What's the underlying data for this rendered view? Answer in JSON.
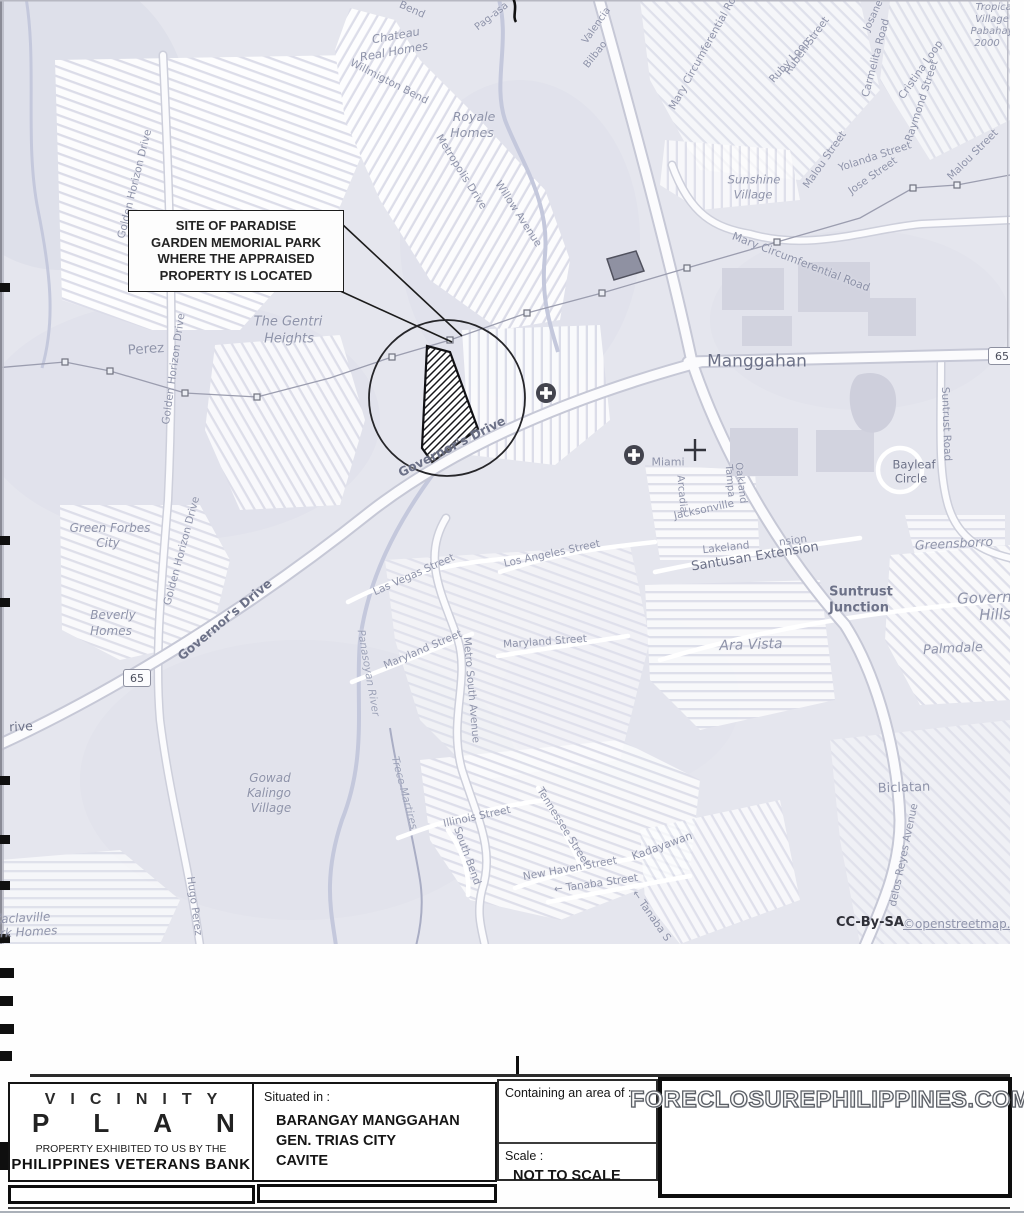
{
  "map": {
    "background": "#e5e6ee",
    "callout": {
      "lines": [
        "SITE OF PARADISE",
        "GARDEN MEMORIAL PARK",
        "WHERE THE APPRAISED",
        "PROPERTY IS LOCATED"
      ]
    },
    "route_shields": [
      {
        "label": "65",
        "x": 1002,
        "y": 356
      },
      {
        "label": "65",
        "x": 137,
        "y": 678
      }
    ],
    "attribution": {
      "text": "CC-By-SA",
      "link": "©openstreetmap.org"
    },
    "icons": [
      {
        "name": "hospital-icon",
        "x": 546,
        "y": 393
      },
      {
        "name": "hospital-icon",
        "x": 634,
        "y": 455
      },
      {
        "name": "junction-cross-icon",
        "x": 695,
        "y": 450
      }
    ],
    "labels": [
      {
        "t": "Bend",
        "x": 412,
        "y": 10,
        "r": 24,
        "fs": 10.5
      },
      {
        "t": "Pag-asa",
        "x": 492,
        "y": 17,
        "r": -38,
        "fs": 10
      },
      {
        "t": "Valencia",
        "x": 597,
        "y": 26,
        "r": -55,
        "fs": 10
      },
      {
        "t": "Bilbao",
        "x": 596,
        "y": 55,
        "r": -52,
        "fs": 10
      },
      {
        "t": "Chateau",
        "x": 396,
        "y": 36,
        "r": -10,
        "fs": 11.5,
        "it": 1
      },
      {
        "t": "Real Homes",
        "x": 394,
        "y": 52,
        "r": -10,
        "fs": 11.5,
        "it": 1
      },
      {
        "t": "Willmigton Bend",
        "x": 389,
        "y": 82,
        "r": 27,
        "fs": 10.5
      },
      {
        "t": "Royale",
        "x": 474,
        "y": 117,
        "fs": 12.5,
        "it": 1
      },
      {
        "t": "Homes",
        "x": 472,
        "y": 133,
        "fs": 12.5,
        "it": 1
      },
      {
        "t": "Metropolis Drive",
        "x": 461,
        "y": 172,
        "r": 58,
        "fs": 10.5
      },
      {
        "t": "Willow Avenue",
        "x": 518,
        "y": 214,
        "r": 57,
        "fs": 10.5
      },
      {
        "t": "Mary Circumferential Road",
        "x": 706,
        "y": 48,
        "r": -61,
        "fs": 10.5
      },
      {
        "t": "Josane",
        "x": 874,
        "y": 16,
        "r": -65,
        "fs": 10
      },
      {
        "t": "Ruben Street",
        "x": 807,
        "y": 46,
        "r": -54,
        "fs": 10.5
      },
      {
        "t": "Ruby Loop",
        "x": 790,
        "y": 61,
        "r": -48,
        "fs": 10.5
      },
      {
        "t": "Carmelita Road",
        "x": 876,
        "y": 58,
        "r": -75,
        "fs": 10.5
      },
      {
        "t": "Cristina Loop",
        "x": 921,
        "y": 70,
        "r": -55,
        "fs": 10.5
      },
      {
        "t": "Raymond Street",
        "x": 922,
        "y": 101,
        "r": -72,
        "fs": 10.5
      },
      {
        "t": "Malou Street",
        "x": 825,
        "y": 160,
        "r": -55,
        "fs": 10.5
      },
      {
        "t": "Yolanda Street",
        "x": 875,
        "y": 157,
        "r": -18,
        "fs": 10.5
      },
      {
        "t": "Jose Street",
        "x": 873,
        "y": 176,
        "r": -35,
        "fs": 10.5
      },
      {
        "t": "Malou Street",
        "x": 973,
        "y": 155,
        "r": -45,
        "fs": 10.5
      },
      {
        "t": "Sunshine",
        "x": 754,
        "y": 180,
        "fs": 11.5,
        "it": 1
      },
      {
        "t": "Village",
        "x": 753,
        "y": 195,
        "fs": 11.5,
        "it": 1
      },
      {
        "t": "Tropical",
        "x": 995,
        "y": 8,
        "fs": 10,
        "it": 1
      },
      {
        "t": "Village",
        "x": 992,
        "y": 20,
        "fs": 10,
        "it": 1
      },
      {
        "t": "Pabahay",
        "x": 992,
        "y": 32,
        "fs": 10,
        "it": 1
      },
      {
        "t": "2000",
        "x": 987,
        "y": 44,
        "fs": 10,
        "it": 1
      },
      {
        "t": "Mary Circumferential Road",
        "x": 801,
        "y": 262,
        "r": 21,
        "fs": 11
      },
      {
        "t": "Manggahan",
        "x": 757,
        "y": 362,
        "fs": 17,
        "c": "d"
      },
      {
        "t": "Suntrust Road",
        "x": 946,
        "y": 424,
        "r": 88,
        "fs": 10.5
      },
      {
        "t": "Bayleaf",
        "x": 914,
        "y": 465,
        "fs": 11.5,
        "c": "d"
      },
      {
        "t": "Circle",
        "x": 911,
        "y": 479,
        "fs": 11.5,
        "c": "d"
      },
      {
        "t": "Miami",
        "x": 668,
        "y": 462,
        "fs": 11
      },
      {
        "t": "Oakland",
        "x": 740,
        "y": 483,
        "r": 83,
        "fs": 10
      },
      {
        "t": "Tampa",
        "x": 729,
        "y": 481,
        "r": 85,
        "fs": 10
      },
      {
        "t": "Arcadia",
        "x": 681,
        "y": 494,
        "r": 85,
        "fs": 10
      },
      {
        "t": "Jacksonville",
        "x": 704,
        "y": 510,
        "r": -12,
        "fs": 10.5
      },
      {
        "t": "Lakeland",
        "x": 726,
        "y": 548,
        "r": -6,
        "fs": 10.5
      },
      {
        "t": "Santusan Extension",
        "x": 755,
        "y": 557,
        "r": -9,
        "fs": 13,
        "c": "d"
      },
      {
        "t": "nsion",
        "x": 793,
        "y": 541,
        "r": -8,
        "fs": 10.5
      },
      {
        "t": "Governor's Drive",
        "x": 452,
        "y": 447,
        "r": -27,
        "fs": 12.5,
        "c": "d",
        "b": 1
      },
      {
        "t": "Governor's Drive",
        "x": 225,
        "y": 620,
        "r": -40,
        "fs": 12.5,
        "c": "d",
        "b": 1
      },
      {
        "t": "Golden Horizon Drive",
        "x": 135,
        "y": 184,
        "r": -76,
        "fs": 10.5
      },
      {
        "t": "Golden Horizon Drive",
        "x": 174,
        "y": 369,
        "r": -82,
        "fs": 10.5
      },
      {
        "t": "Golden Horizon Drive",
        "x": 182,
        "y": 551,
        "r": -75,
        "fs": 10.5
      },
      {
        "t": "Perez",
        "x": 146,
        "y": 350,
        "r": -4,
        "fs": 13.5
      },
      {
        "t": "The Gentri",
        "x": 288,
        "y": 322,
        "fs": 13,
        "it": 1
      },
      {
        "t": "Heights",
        "x": 289,
        "y": 339,
        "fs": 13,
        "it": 1
      },
      {
        "t": "Green Forbes",
        "x": 110,
        "y": 528,
        "fs": 12,
        "it": 1
      },
      {
        "t": "City",
        "x": 108,
        "y": 543,
        "fs": 12,
        "it": 1
      },
      {
        "t": "Beverly",
        "x": 113,
        "y": 615,
        "fs": 12,
        "it": 1
      },
      {
        "t": "Homes",
        "x": 111,
        "y": 631,
        "fs": 12,
        "it": 1
      },
      {
        "t": "rive",
        "x": 21,
        "y": 727,
        "r": -3,
        "fs": 12.5,
        "c": "d"
      },
      {
        "t": "Las Vegas Street",
        "x": 414,
        "y": 575,
        "r": -24,
        "fs": 10.5
      },
      {
        "t": "Los Angeles Street",
        "x": 552,
        "y": 554,
        "r": -12,
        "fs": 10.5
      },
      {
        "t": "Maryland Street",
        "x": 423,
        "y": 650,
        "r": -23,
        "fs": 10.5
      },
      {
        "t": "Maryland Street",
        "x": 545,
        "y": 642,
        "r": -4,
        "fs": 10.5
      },
      {
        "t": "Metro South Avenue",
        "x": 471,
        "y": 690,
        "r": 85,
        "fs": 10.5
      },
      {
        "t": "Panasoyan River",
        "x": 368,
        "y": 673,
        "r": 80,
        "fs": 10.5,
        "c": "i",
        "it": 1
      },
      {
        "t": "Trece Martires",
        "x": 404,
        "y": 793,
        "r": 75,
        "fs": 10.5,
        "c": "i",
        "it": 1
      },
      {
        "t": "Gowad",
        "x": 270,
        "y": 778,
        "fs": 12,
        "it": 1
      },
      {
        "t": "Kalingo",
        "x": 269,
        "y": 793,
        "fs": 12,
        "it": 1
      },
      {
        "t": "Village",
        "x": 271,
        "y": 808,
        "fs": 12,
        "it": 1
      },
      {
        "t": "Hugo Perez",
        "x": 194,
        "y": 906,
        "r": 82,
        "fs": 10.5
      },
      {
        "t": "Kaclaville",
        "x": 22,
        "y": 918,
        "r": -3,
        "fs": 12,
        "it": 1
      },
      {
        "t": "ark Homes",
        "x": 25,
        "y": 932,
        "r": -3,
        "fs": 12,
        "it": 1
      },
      {
        "t": "Illinois Street",
        "x": 477,
        "y": 817,
        "r": -12,
        "fs": 10.5
      },
      {
        "t": "South Bend",
        "x": 467,
        "y": 856,
        "r": 70,
        "fs": 10.5
      },
      {
        "t": "Tennessee Street",
        "x": 563,
        "y": 827,
        "r": 58,
        "fs": 10.5
      },
      {
        "t": "New Haven Street",
        "x": 570,
        "y": 869,
        "r": -10,
        "fs": 10.5
      },
      {
        "t": "← Tanaba Street",
        "x": 596,
        "y": 884,
        "r": -8,
        "fs": 10.5
      },
      {
        "t": "Kadayawan",
        "x": 662,
        "y": 846,
        "r": -20,
        "fs": 11
      },
      {
        "t": "← Tanaba S",
        "x": 651,
        "y": 916,
        "r": 55,
        "fs": 10.5
      },
      {
        "t": "Ara Vista",
        "x": 751,
        "y": 645,
        "r": -2,
        "fs": 14,
        "it": 1
      },
      {
        "t": "Suntrust",
        "x": 861,
        "y": 592,
        "fs": 13,
        "c": "d",
        "b": 1
      },
      {
        "t": "Junction",
        "x": 859,
        "y": 608,
        "fs": 13,
        "c": "d",
        "b": 1
      },
      {
        "t": "Greensborro",
        "x": 954,
        "y": 544,
        "r": -3,
        "fs": 12.5,
        "it": 1
      },
      {
        "t": "Governor",
        "x": 992,
        "y": 598,
        "r": -2,
        "fs": 15,
        "it": 1
      },
      {
        "t": "Hills",
        "x": 995,
        "y": 615,
        "r": -2,
        "fs": 15,
        "it": 1
      },
      {
        "t": "Palmdale",
        "x": 953,
        "y": 649,
        "r": -3,
        "fs": 13,
        "it": 1
      },
      {
        "t": "Biclatan",
        "x": 904,
        "y": 788,
        "r": -2,
        "fs": 13
      },
      {
        "t": "delos Reyes Avenue",
        "x": 904,
        "y": 855,
        "r": -78,
        "fs": 10.5
      }
    ]
  },
  "title_block": {
    "title_line1": "VICINITY",
    "title_line2": "PLAN",
    "subtitle1": "PROPERTY EXHIBITED TO US BY THE",
    "subtitle2": "PHILIPPINES VETERANS BANK",
    "situated_label": "Situated in :",
    "situated_line1": "BARANGAY MANGGAHAN",
    "situated_line2": "GEN. TRIAS CITY",
    "situated_line3": "CAVITE",
    "area_label": "Containing an area of :",
    "scale_label": "Scale :",
    "scale_value": "NOT TO SCALE"
  },
  "watermark": "FORECLOSUREPHILIPPINES.COM"
}
